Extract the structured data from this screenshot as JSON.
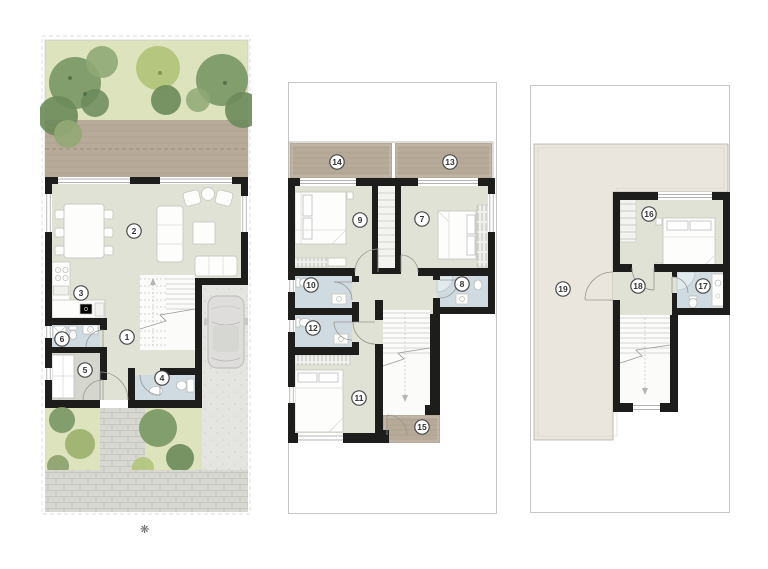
{
  "sheet": {
    "background": "#ffffff"
  },
  "icons": {
    "sun": "❋"
  },
  "markers": {
    "m1": "1",
    "m2": "2",
    "m3": "3",
    "m4": "4",
    "m5": "5",
    "m6": "6",
    "m7": "7",
    "m8": "8",
    "m9": "9",
    "m10": "10",
    "m11": "11",
    "m12": "12",
    "m13": "13",
    "m14": "14",
    "m15": "15",
    "m16": "16",
    "m17": "17",
    "m18": "18",
    "m19": "19"
  },
  "plans": [
    {
      "id": "ground-floor",
      "room_markers": [
        "1",
        "2",
        "3",
        "4",
        "5",
        "6"
      ],
      "graphics": [
        "rear-garden-trees",
        "wood-deck",
        "living-dining-furniture",
        "kitchen-counter",
        "stairs",
        "bathroom",
        "utility-room",
        "guest-toilet",
        "driveway-with-car",
        "front-garden",
        "cobblestone-paving"
      ]
    },
    {
      "id": "first-floor",
      "room_markers": [
        "7",
        "8",
        "9",
        "10",
        "11",
        "12",
        "13",
        "14",
        "15"
      ],
      "graphics": [
        "front-terraces",
        "bedrooms-with-beds",
        "bathrooms",
        "wardrobes",
        "stairs",
        "rear-terrace"
      ]
    },
    {
      "id": "second-floor",
      "room_markers": [
        "16",
        "17",
        "18",
        "19"
      ],
      "graphics": [
        "roof-terrace",
        "bedroom-with-bed",
        "bathroom",
        "hall",
        "stairs"
      ]
    }
  ],
  "colors": {
    "sheet": "#ffffff",
    "wall": "#1d1d1b",
    "floor": "#dfe2d4",
    "floorGray": "#d5d7cf",
    "bathFloor": "#cfdae1",
    "shower": "#e2eaee",
    "deck": "#b7aa99",
    "deckLine": "#a6998a",
    "grass": "#dce3bd",
    "treeDark": "#6b8a5a",
    "treeMid": "#7d9a68",
    "treeLight": "#b2c47a",
    "olive": "#9fb271",
    "paving": "#d8d8d2",
    "pavingLine": "#c2c2bb",
    "drive": "#e4e4e0",
    "roofTerrace": "#eae6dd",
    "frame": "#c6c6c6",
    "furnStroke": "#c9c9c4",
    "markerStroke": "#4a4a4a",
    "markerText": "#333333",
    "arc": "#969690"
  }
}
